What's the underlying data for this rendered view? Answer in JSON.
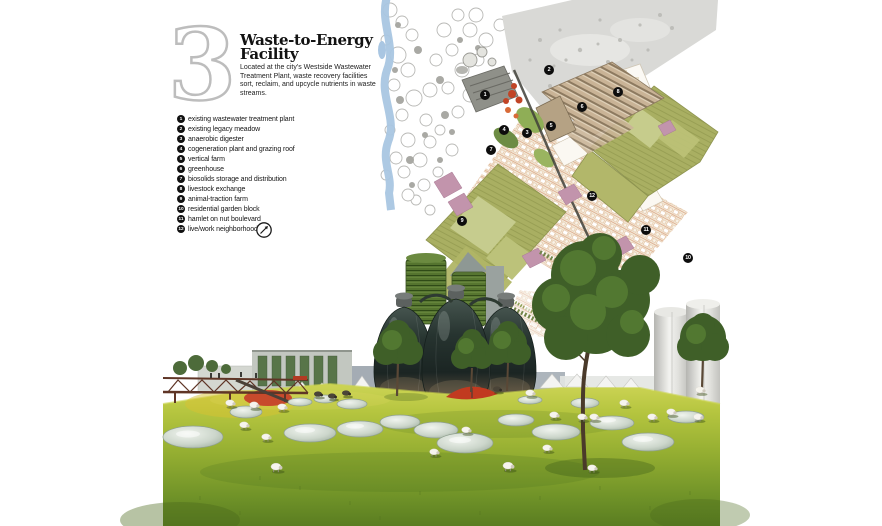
{
  "header": {
    "number": "3",
    "title_line1": "Waste-to-Energy",
    "title_line2": "Facility",
    "description": "Located at the city’s Westside Wastewater Treatment Plant, waste recovery facilities sort, reclaim, and upcycle nutrients in waste streams."
  },
  "legend": {
    "items": [
      {
        "num": "1",
        "label": "existing wastewater treatment plant"
      },
      {
        "num": "2",
        "label": "existing legacy meadow"
      },
      {
        "num": "3",
        "label": "anaerobic digester"
      },
      {
        "num": "4",
        "label": "cogeneration plant and grazing roof"
      },
      {
        "num": "5",
        "label": "vertical farm"
      },
      {
        "num": "6",
        "label": "greenhouse"
      },
      {
        "num": "7",
        "label": "biosolids storage and distribution"
      },
      {
        "num": "8",
        "label": "livestock exchange"
      },
      {
        "num": "9",
        "label": "animal-traction farm"
      },
      {
        "num": "10",
        "label": "residential garden block"
      },
      {
        "num": "11",
        "label": "hamlet on nut boulevard"
      },
      {
        "num": "12",
        "label": "live/work neighborhood"
      }
    ],
    "north_icon": "compass-north-arrow"
  },
  "map": {
    "markers": [
      {
        "num": "1",
        "x": 485,
        "y": 95
      },
      {
        "num": "2",
        "x": 549,
        "y": 70
      },
      {
        "num": "3",
        "x": 527,
        "y": 133
      },
      {
        "num": "4",
        "x": 504,
        "y": 130
      },
      {
        "num": "5",
        "x": 551,
        "y": 126
      },
      {
        "num": "6",
        "x": 582,
        "y": 107
      },
      {
        "num": "7",
        "x": 491,
        "y": 150
      },
      {
        "num": "8",
        "x": 618,
        "y": 92
      },
      {
        "num": "9",
        "x": 462,
        "y": 221
      },
      {
        "num": "10",
        "x": 688,
        "y": 258
      },
      {
        "num": "11",
        "x": 646,
        "y": 230
      },
      {
        "num": "12",
        "x": 592,
        "y": 196
      }
    ]
  },
  "colors": {
    "field_olive": "#a9af62",
    "field_light": "#c6cc8e",
    "meadow_gray": "#d9d9d6",
    "river_blue": "#a9c6e2",
    "housing_cream": "#f3ebdb",
    "housing_line": "#d89a74",
    "accent_mauve": "#c294ac",
    "digester_red": "#c14426",
    "grass_bright": "#c6cf4e",
    "grass_dark": "#5a7d21",
    "egg_glass": "#1b2523",
    "tower_green": "#55742f"
  }
}
